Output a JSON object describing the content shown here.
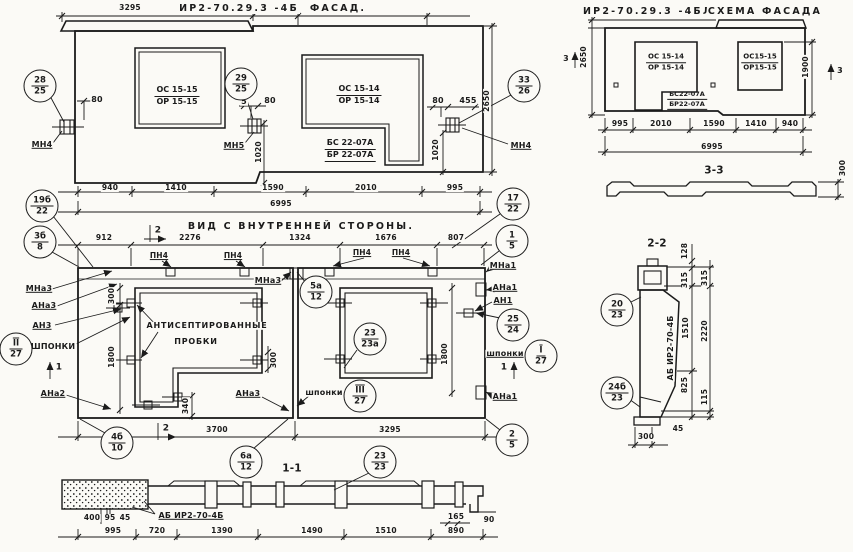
{
  "sheet": {
    "paper_color": "#fbfaf6",
    "ink_color": "#1b1b1b"
  },
  "facade": {
    "code": "ИР2-70.29.3 -4б",
    "title": "Фасад.",
    "win1": {
      "a": "ОС 15-15",
      "b": "ОР 15-15"
    },
    "win2": {
      "a": "ОС 15-14",
      "b": "ОР 15-14"
    },
    "balc": {
      "a": "БС 22-07А",
      "b": "БР 22-07А"
    },
    "anchor_left": "МН4",
    "anchor_mid": "МН5",
    "anchor_right": "МН4",
    "c28": {
      "t": "28",
      "b": "25"
    },
    "c29": {
      "t": "29",
      "b": "25"
    },
    "c33": {
      "t": "33",
      "b": "26"
    },
    "dims": {
      "top": "3295",
      "d80l": "80",
      "d5": "5",
      "d80m": "80",
      "d80r": "80",
      "d455": "455",
      "d1020a": "1020",
      "d1020b": "1020",
      "d2650": "2650",
      "total": "6995"
    },
    "chain": [
      "940",
      "1410",
      "1590",
      "2010",
      "995"
    ]
  },
  "scheme": {
    "code": "ИР2-70.29.3 -4бл",
    "title": "Схема фасада",
    "win1": {
      "a": "ОС 15-14",
      "b": "ОР 15-14"
    },
    "win2": {
      "a": "ОС15-15",
      "b": "ОР15-15"
    },
    "balc": {
      "a": "БС22-07А",
      "b": "БР22-07А"
    },
    "dims": {
      "height_left": "2650",
      "height_right": "1900",
      "total": "6995",
      "d300": "300"
    },
    "marks": {
      "m3": "3"
    },
    "chain": [
      "995",
      "2010",
      "1590",
      "1410",
      "940"
    ],
    "section_label": "3-3"
  },
  "inner": {
    "title": "Вид с внутренней стороны.",
    "chain": [
      "912",
      "2276",
      "1324",
      "1676",
      "807"
    ],
    "pn4": "ПН4",
    "note1": "Антисептированные",
    "note2": "пробки",
    "labels": {
      "mna3": "МНа3",
      "ana3": "АНа3",
      "an3": "АН3",
      "shponki_big": "ШПОНКИ",
      "ana2": "АНа2",
      "mna3_in": "МНа3",
      "ana3_in": "АНа3",
      "shponki": "шпонки",
      "mna1": "МНа1",
      "ana1a": "АНа1",
      "an1": "АН1",
      "ana1b": "АНа1"
    },
    "c19b": {
      "t": "19б",
      "b": "22"
    },
    "c3b": {
      "t": "3б",
      "b": "8"
    },
    "cII": {
      "t": "II",
      "b": "27"
    },
    "c4b": {
      "t": "4б",
      "b": "10"
    },
    "c17": {
      "t": "17",
      "b": "22"
    },
    "c1": {
      "t": "1",
      "b": "5"
    },
    "c25": {
      "t": "25",
      "b": "24"
    },
    "cI": {
      "t": "I",
      "b": "27"
    },
    "c2": {
      "t": "2",
      "b": "5"
    },
    "c5a": {
      "t": "5а",
      "b": "12"
    },
    "c23a": {
      "t": "23",
      "b": "23а"
    },
    "cIII": {
      "t": "III",
      "b": "27"
    },
    "dims": {
      "d300l": "300",
      "d1800l": "1800",
      "d300m": "300",
      "d340": "340",
      "d1800r": "1800",
      "d3700": "3700",
      "d3295": "3295"
    },
    "marks": {
      "m1": "1",
      "m2": "2"
    }
  },
  "s11": {
    "label": "1-1",
    "c6a": {
      "t": "6а",
      "b": "12"
    },
    "c23": {
      "t": "23",
      "b": "23"
    },
    "ab_label": "АБ ИР2-70-4Б",
    "d400": "400",
    "d95": "95",
    "d45": "45",
    "chain": [
      "995",
      "720",
      "1390",
      "1490",
      "1510",
      "890"
    ],
    "d165": "165",
    "d90": "90"
  },
  "s22": {
    "label": "2-2",
    "c20": {
      "t": "20",
      "b": "23"
    },
    "c24b": {
      "t": "24б",
      "b": "23"
    },
    "ab_label": "АБ ИР2-70-4Б",
    "d128": "128",
    "d315a": "315",
    "d1510": "1510",
    "d825": "825",
    "d315b": "315",
    "d2220": "2220",
    "d115": "115",
    "d45": "45",
    "d300": "300"
  }
}
